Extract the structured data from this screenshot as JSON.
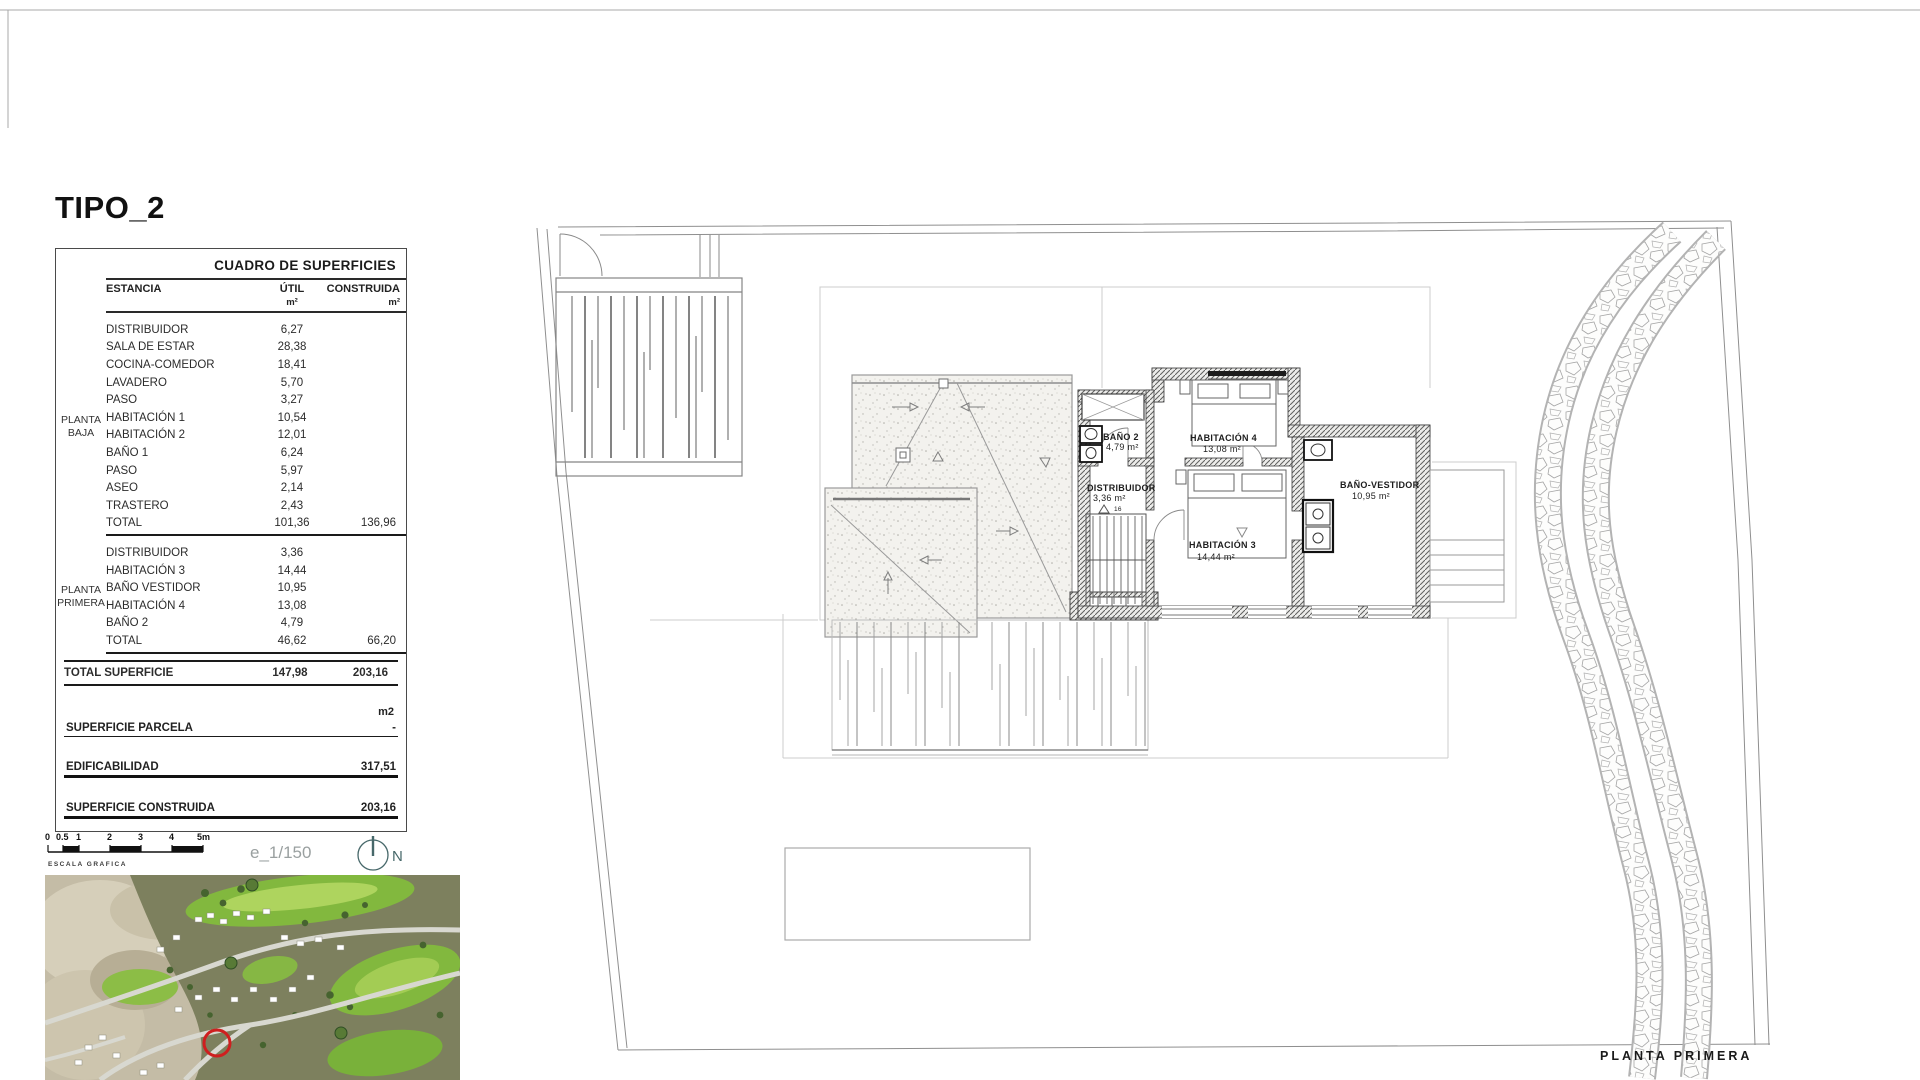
{
  "page": {
    "title": "TIPO_2"
  },
  "table": {
    "title": "CUADRO DE SUPERFICIES",
    "col_estancia": "ESTANCIA",
    "col_util": "ÚTIL",
    "col_built": "CONSTRUIDA",
    "unit": "m²",
    "groups": [
      {
        "name1": "PLANTA",
        "name2": "BAJA",
        "rows": [
          {
            "label": "DISTRIBUIDOR",
            "util": "6,27"
          },
          {
            "label": "SALA DE ESTAR",
            "util": "28,38"
          },
          {
            "label": "COCINA-COMEDOR",
            "util": "18,41"
          },
          {
            "label": "LAVADERO",
            "util": "5,70"
          },
          {
            "label": "PASO",
            "util": "3,27"
          },
          {
            "label": "HABITACIÓN 1",
            "util": "10,54"
          },
          {
            "label": "HABITACIÓN 2",
            "util": "12,01"
          },
          {
            "label": "BAÑO 1",
            "util": "6,24"
          },
          {
            "label": "PASO",
            "util": "5,97"
          },
          {
            "label": "ASEO",
            "util": "2,14"
          },
          {
            "label": "TRASTERO",
            "util": "2,43"
          }
        ],
        "total_label": "TOTAL",
        "total_util": "101,36",
        "total_built": "136,96"
      },
      {
        "name1": "PLANTA",
        "name2": "PRIMERA",
        "rows": [
          {
            "label": "DISTRIBUIDOR",
            "util": "3,36"
          },
          {
            "label": "HABITACIÓN 3",
            "util": "14,44"
          },
          {
            "label": "BAÑO VESTIDOR",
            "util": "10,95"
          },
          {
            "label": "HABITACIÓN 4",
            "util": "13,08"
          },
          {
            "label": "BAÑO 2",
            "util": "4,79"
          }
        ],
        "total_label": "TOTAL",
        "total_util": "46,62",
        "total_built": "66,20"
      }
    ],
    "summary_label": "TOTAL SUPERFICIE",
    "summary_util": "147,98",
    "summary_built": "203,16",
    "m2_label": "m2",
    "parcela_label": "SUPERFICIE PARCELA",
    "parcela_value": "-",
    "edificabilidad_label": "EDIFICABILIDAD",
    "edificabilidad_value": "317,51",
    "construida_label": "SUPERFICIE CONSTRUIDA",
    "construida_value": "203,16"
  },
  "scale": {
    "ticks": [
      "0",
      "0.5",
      "1",
      "2",
      "3",
      "4",
      "5m"
    ],
    "caption": "ESCALA GRAFICA",
    "ratio": "e_1/150",
    "north": "N"
  },
  "plan": {
    "caption": "PLANTA PRIMERA",
    "stair_note": "16",
    "rooms": [
      {
        "name": "BAÑO 2",
        "area": "4,79 m²"
      },
      {
        "name": "HABITACIÓN 4",
        "area": "13,08 m²"
      },
      {
        "name": "DISTRIBUIDOR",
        "area": "3,36 m²"
      },
      {
        "name": "BAÑO-VESTIDOR",
        "area": "10,95 m²"
      },
      {
        "name": "HABITACIÓN 3",
        "area": "14,44 m²"
      }
    ]
  }
}
